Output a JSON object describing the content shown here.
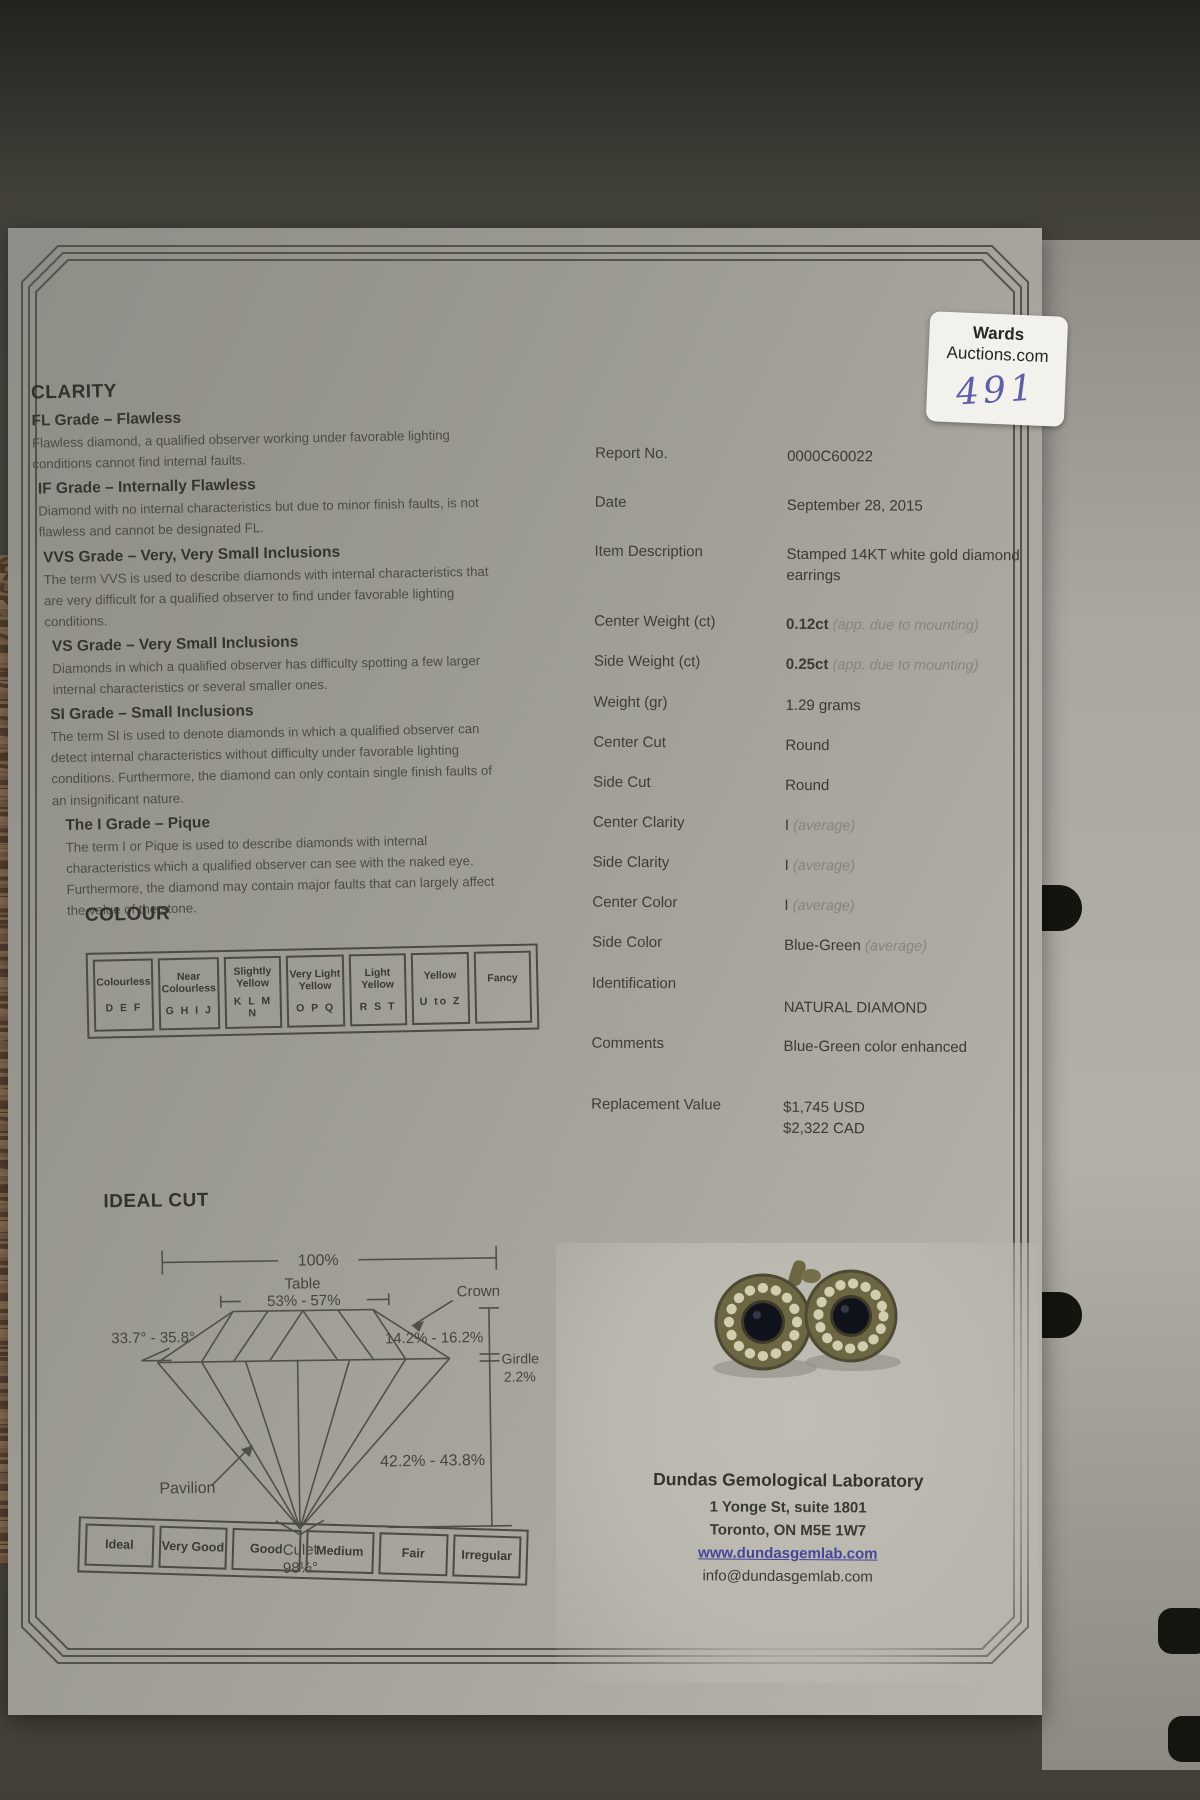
{
  "sticker": {
    "brand_line1": "Wards",
    "brand_line2": "Auctions.com",
    "lot_number": "491"
  },
  "clarity": {
    "title": "CLARITY",
    "grades": [
      {
        "heading": "FL Grade – Flawless",
        "description": "Flawless diamond, a qualified observer working under favorable lighting conditions cannot find internal faults."
      },
      {
        "heading": "IF Grade – Internally Flawless",
        "description": "Diamond with no internal characteristics but due to minor finish faults, is not flawless and cannot be designated FL."
      },
      {
        "heading": "VVS Grade – Very, Very Small Inclusions",
        "description": "The term VVS is used to describe diamonds with internal characteristics that are very difficult for a qualified observer to find under favorable lighting conditions."
      },
      {
        "heading": "VS Grade – Very Small Inclusions",
        "description": "Diamonds in which a qualified observer has difficulty spotting a few larger internal characteristics or several smaller ones."
      },
      {
        "heading": "SI Grade – Small Inclusions",
        "description": "The term SI is used to denote diamonds in which a qualified observer can detect internal characteristics without difficulty under favorable lighting conditions. Furthermore, the diamond can only contain single finish faults of an insignificant nature."
      },
      {
        "heading": "The I Grade – Pique",
        "description": "The term I or Pique is used to describe diamonds with internal characteristics which a qualified observer can see with the naked eye. Furthermore, the diamond may contain major faults that can largely affect the value of the stone."
      }
    ]
  },
  "colour": {
    "title": "COLOUR",
    "scale": [
      {
        "name": "Colourless",
        "letters": "D E F"
      },
      {
        "name": "Near Colourless",
        "letters": "G H I J"
      },
      {
        "name": "Slightly Yellow",
        "letters": "K L M N"
      },
      {
        "name": "Very Light Yellow",
        "letters": "O P Q"
      },
      {
        "name": "Light Yellow",
        "letters": "R S T"
      },
      {
        "name": "Yellow",
        "letters": "U to Z"
      },
      {
        "name": "Fancy",
        "letters": ""
      }
    ]
  },
  "ideal_cut": {
    "title": "IDEAL CUT",
    "labels": {
      "total": "100%",
      "table_label": "Table",
      "table_pct": "53% - 57%",
      "crown": "Crown",
      "crown_angle": "33.7° - 35.8°",
      "crown_pct": "14.2% - 16.2%",
      "girdle": "Girdle",
      "girdle_pct": "2.2%",
      "pavilion_pct": "42.2% - 43.8%",
      "pavilion": "Pavilion",
      "culet": "Culet",
      "culet_angle": "98½°"
    },
    "cut_grades": [
      "Ideal",
      "Very Good",
      "Good",
      "Medium",
      "Fair",
      "Irregular"
    ]
  },
  "report": {
    "rows": [
      {
        "label": "Report No.",
        "value": "0000C60022"
      },
      {
        "label": "Date",
        "value": "September 28, 2015"
      },
      {
        "label": "Item Description",
        "value": "Stamped 14KT white gold diamond earrings"
      },
      {
        "label": "Center Weight (ct)",
        "value": "0.12ct",
        "note": "(app. due to mounting)"
      },
      {
        "label": "Side Weight (ct)",
        "value": "0.25ct",
        "note": "(app. due to mounting)"
      },
      {
        "label": "Weight (gr)",
        "value": "1.29 grams"
      },
      {
        "label": "Center Cut",
        "value": "Round"
      },
      {
        "label": "Side Cut",
        "value": "Round"
      },
      {
        "label": "Center Clarity",
        "value": "I",
        "note": "(average)"
      },
      {
        "label": "Side Clarity",
        "value": "I",
        "note": "(average)"
      },
      {
        "label": "Center Color",
        "value": "I",
        "note": "(average)"
      },
      {
        "label": "Side Color",
        "value": "Blue-Green",
        "note": "(average)"
      },
      {
        "label": "Identification",
        "value": "NATURAL DIAMOND"
      },
      {
        "label": "Comments",
        "value": "Blue-Green color enhanced"
      },
      {
        "label": "Replacement Value",
        "value": "$1,745 USD",
        "value2": "$2,322 CAD"
      }
    ]
  },
  "lab": {
    "name": "Dundas Gemological Laboratory",
    "address1": "1 Yonge St, suite 1801",
    "address2": "Toronto, ON M5E 1W7",
    "website": "www.dundasgemlab.com",
    "email": "info@dundasgemlab.com"
  },
  "colors": {
    "handwriting_ink": "#5d5dac",
    "link_blue": "#45459e",
    "paper_gray": "#a5a39b",
    "frame_line": "#53534c"
  }
}
